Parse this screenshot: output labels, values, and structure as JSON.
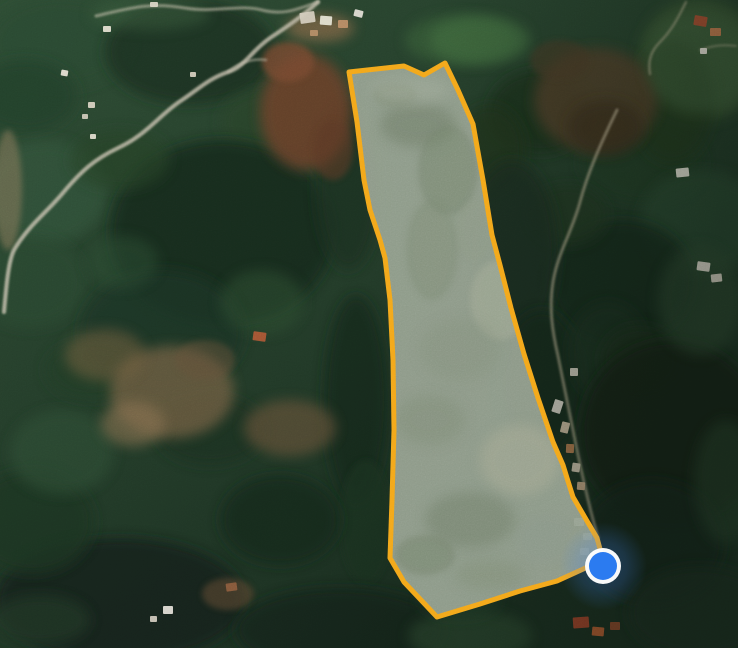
{
  "map": {
    "width": 738,
    "height": 648,
    "type_label": "satellite-imagery",
    "base_gradient": [
      [
        "0",
        "#2e4c34"
      ],
      [
        "1",
        "#1b2f21"
      ]
    ],
    "shade_stops": [
      [
        "0",
        "rgba(8,16,10,0)"
      ],
      [
        "0.55",
        "rgba(8,16,10,0.05)"
      ],
      [
        "1",
        "rgba(8,16,10,0.34)"
      ]
    ],
    "grain_opacity": 0.16
  },
  "forest_blobs": [
    [
      60,
      42,
      72,
      46,
      "#2c4a31",
      0.8
    ],
    [
      25,
      96,
      52,
      36,
      "#24402a",
      0.8
    ],
    [
      190,
      52,
      85,
      52,
      "#1b3020",
      0.85
    ],
    [
      150,
      14,
      60,
      16,
      "#3a5c3c",
      0.5
    ],
    [
      262,
      122,
      42,
      32,
      "#2a452c",
      0.7
    ],
    [
      45,
      192,
      62,
      52,
      "#33523a",
      0.75
    ],
    [
      30,
      282,
      56,
      46,
      "#2b4833",
      0.7
    ],
    [
      222,
      232,
      112,
      92,
      "#182b1e",
      0.85
    ],
    [
      162,
      332,
      82,
      62,
      "#1f3625",
      0.8
    ],
    [
      262,
      302,
      42,
      32,
      "#2f4f33",
      0.55
    ],
    [
      122,
      262,
      36,
      26,
      "#2c4b31",
      0.55
    ],
    [
      120,
      160,
      50,
      30,
      "#274228",
      0.6
    ],
    [
      348,
      185,
      32,
      85,
      "#1c3122",
      0.8
    ],
    [
      356,
      400,
      32,
      105,
      "#192c1f",
      0.8
    ],
    [
      366,
      522,
      26,
      62,
      "#1e3424",
      0.75
    ],
    [
      120,
      600,
      125,
      62,
      "#13231a",
      0.85
    ],
    [
      32,
      522,
      62,
      52,
      "#1c3424",
      0.8
    ],
    [
      62,
      452,
      52,
      42,
      "#2e4e34",
      0.65
    ],
    [
      90,
      370,
      45,
      30,
      "#223c28",
      0.6
    ],
    [
      210,
      430,
      55,
      35,
      "#1d3322",
      0.7
    ],
    [
      280,
      520,
      60,
      45,
      "#182b1e",
      0.8
    ],
    [
      40,
      620,
      50,
      25,
      "#203725",
      0.7
    ],
    [
      340,
      630,
      105,
      42,
      "#15271b",
      0.85
    ],
    [
      470,
      636,
      62,
      26,
      "#2f4c31",
      0.65
    ],
    [
      460,
      600,
      40,
      18,
      "#24402a",
      0.6
    ],
    [
      540,
      112,
      52,
      42,
      "#1b301f",
      0.8
    ],
    [
      490,
      150,
      35,
      45,
      "#20361f",
      0.7
    ],
    [
      460,
      40,
      55,
      25,
      "#3f6a3e",
      0.5
    ],
    [
      642,
      162,
      62,
      42,
      "#243d28",
      0.7
    ],
    [
      700,
      60,
      62,
      62,
      "#3e5a36",
      0.7
    ],
    [
      672,
      102,
      42,
      62,
      "#22381f",
      0.65
    ],
    [
      702,
      222,
      62,
      52,
      "#2c4830",
      0.75
    ],
    [
      622,
      282,
      72,
      62,
      "#182b1e",
      0.85
    ],
    [
      568,
      215,
      40,
      30,
      "#203823",
      0.7
    ],
    [
      512,
      252,
      46,
      92,
      "#1a2e20",
      0.8
    ],
    [
      542,
      382,
      42,
      72,
      "#17291d",
      0.85
    ],
    [
      608,
      352,
      40,
      50,
      "#1d3223",
      0.7
    ],
    [
      640,
      360,
      40,
      35,
      "#1a2e1f",
      0.7
    ],
    [
      672,
      432,
      92,
      92,
      "#122217",
      0.9
    ],
    [
      652,
      542,
      72,
      62,
      "#16281c",
      0.85
    ],
    [
      726,
      482,
      32,
      62,
      "#25402a",
      0.65
    ],
    [
      700,
      612,
      72,
      46,
      "#1a2f20",
      0.8
    ]
  ],
  "terrain_patches": [
    [
      306,
      112,
      46,
      58,
      "#6f432c",
      0.85
    ],
    [
      288,
      62,
      26,
      20,
      "#7c4c30",
      0.8
    ],
    [
      320,
      28,
      34,
      14,
      "#8a6a48",
      0.7
    ],
    [
      333,
      150,
      20,
      30,
      "#5e3a28",
      0.6
    ],
    [
      596,
      100,
      62,
      52,
      "#52402c",
      0.8
    ],
    [
      606,
      128,
      38,
      28,
      "#3a2e1f",
      0.7
    ],
    [
      560,
      60,
      30,
      20,
      "#4a3a28",
      0.6
    ],
    [
      172,
      392,
      62,
      46,
      "#7c6546",
      0.7
    ],
    [
      290,
      428,
      46,
      28,
      "#6b553b",
      0.65
    ],
    [
      133,
      424,
      32,
      22,
      "#8a7251",
      0.6
    ],
    [
      105,
      355,
      40,
      26,
      "#74603f",
      0.55
    ],
    [
      205,
      360,
      30,
      20,
      "#66523a",
      0.5
    ],
    [
      228,
      594,
      26,
      16,
      "#5e4a33",
      0.6
    ],
    [
      700,
      300,
      42,
      55,
      "#2e4a32",
      0.6
    ],
    [
      480,
      40,
      50,
      24,
      "#447243",
      0.65
    ],
    [
      700,
      62,
      55,
      50,
      "#40603c",
      0.6
    ],
    [
      8,
      190,
      14,
      60,
      "#8a7a5c",
      0.55
    ]
  ],
  "roads": [
    {
      "d": "M318,2 C300,18 288,26 270,38 C250,52 246,66 228,72 C208,79 200,88 182,100 C160,114 148,134 118,148 C95,159 82,170 62,194 C45,214 28,226 14,250 C8,262 6,290 4,312",
      "color": "#cfc8b5",
      "width": 4,
      "opacity": 0.8
    },
    {
      "d": "M96,16 C130,8 150,2 185,8 C215,13 240,4 262,10 C285,16 300,8 318,2",
      "color": "#cfc8b5",
      "width": 3,
      "opacity": 0.55
    },
    {
      "d": "M228,72 C240,62 252,58 266,60",
      "color": "#cfc8b5",
      "width": 2.5,
      "opacity": 0.5
    },
    {
      "d": "M617,110 C600,145 588,172 580,202 C572,232 558,252 553,282 C549,308 552,330 558,356 C564,386 570,416 577,450 C583,479 590,510 598,538",
      "color": "#c4b99d",
      "width": 3,
      "opacity": 0.6
    },
    {
      "d": "M686,2 C678,18 672,30 660,42 C650,52 648,62 650,74",
      "color": "#c4b99d",
      "width": 2.5,
      "opacity": 0.5
    },
    {
      "d": "M700,50 C712,46 722,44 736,46",
      "color": "#c4b99d",
      "width": 2,
      "opacity": 0.45
    }
  ],
  "buildings": [
    [
      300,
      12,
      15,
      11,
      "#d9d2c2",
      -8
    ],
    [
      320,
      16,
      12,
      9,
      "#eceada",
      4
    ],
    [
      338,
      20,
      10,
      8,
      "#c09068",
      0
    ],
    [
      354,
      10,
      9,
      7,
      "#e9e6dc",
      14
    ],
    [
      310,
      30,
      8,
      6,
      "#b98f68",
      0
    ],
    [
      103,
      26,
      8,
      6,
      "#e5e1d2",
      0
    ],
    [
      150,
      2,
      8,
      5,
      "#dcd7c7",
      0
    ],
    [
      61,
      70,
      7,
      6,
      "#e8e4d6",
      10
    ],
    [
      88,
      102,
      7,
      6,
      "#d9d3c2",
      0
    ],
    [
      82,
      114,
      6,
      5,
      "#cfc9b8",
      0
    ],
    [
      190,
      72,
      6,
      5,
      "#d6d0bf",
      0
    ],
    [
      90,
      134,
      6,
      5,
      "#e2ddcf",
      0
    ],
    [
      694,
      16,
      13,
      10,
      "#a84e30",
      10
    ],
    [
      710,
      28,
      11,
      8,
      "#c17a4e",
      0
    ],
    [
      700,
      48,
      7,
      6,
      "#e6e2d6",
      0
    ],
    [
      676,
      168,
      13,
      9,
      "#e3dfd3",
      -6
    ],
    [
      697,
      262,
      13,
      9,
      "#ded9cc",
      8
    ],
    [
      711,
      274,
      11,
      8,
      "#d6d0c2",
      -6
    ],
    [
      570,
      368,
      8,
      8,
      "#cfc9ba",
      0
    ],
    [
      553,
      400,
      9,
      13,
      "#d9d5c9",
      18
    ],
    [
      561,
      422,
      8,
      11,
      "#cdbda2",
      14
    ],
    [
      566,
      444,
      8,
      9,
      "#b27c50",
      2
    ],
    [
      572,
      463,
      8,
      9,
      "#d1c6b0",
      8
    ],
    [
      577,
      482,
      8,
      8,
      "#c4a786",
      4
    ],
    [
      574,
      518,
      10,
      8,
      "#e9e6dd",
      0
    ],
    [
      583,
      533,
      9,
      7,
      "#dedacd",
      0
    ],
    [
      580,
      548,
      9,
      7,
      "#e6e3da",
      0
    ],
    [
      573,
      617,
      16,
      11,
      "#a5452b",
      -4
    ],
    [
      592,
      627,
      12,
      9,
      "#b95f33",
      5
    ],
    [
      610,
      622,
      10,
      8,
      "#8f4a2c",
      0
    ],
    [
      253,
      332,
      13,
      9,
      "#b05a36",
      8
    ],
    [
      226,
      583,
      11,
      8,
      "#8f5e3e",
      -8
    ],
    [
      163,
      606,
      10,
      8,
      "#e8e5dc",
      0
    ],
    [
      150,
      616,
      7,
      6,
      "#d4cec0",
      0
    ]
  ],
  "parcel": {
    "points": [
      [
        349,
        72
      ],
      [
        404,
        66
      ],
      [
        424,
        75
      ],
      [
        445,
        63
      ],
      [
        458,
        90
      ],
      [
        473,
        124
      ],
      [
        483,
        180
      ],
      [
        492,
        235
      ],
      [
        500,
        265
      ],
      [
        511,
        308
      ],
      [
        524,
        354
      ],
      [
        538,
        398
      ],
      [
        553,
        442
      ],
      [
        563,
        465
      ],
      [
        567,
        478
      ],
      [
        573,
        497
      ],
      [
        587,
        521
      ],
      [
        597,
        538
      ],
      [
        603,
        560
      ],
      [
        557,
        581
      ],
      [
        520,
        591
      ],
      [
        480,
        604
      ],
      [
        437,
        617
      ],
      [
        404,
        582
      ],
      [
        390,
        558
      ],
      [
        392,
        500
      ],
      [
        394,
        430
      ],
      [
        393,
        360
      ],
      [
        390,
        300
      ],
      [
        385,
        258
      ],
      [
        380,
        240
      ],
      [
        370,
        210
      ],
      [
        364,
        180
      ],
      [
        357,
        122
      ]
    ],
    "fill": "#97a291",
    "fill_opacity": 0.93,
    "stroke": "#f3a71b",
    "stroke_width": 5,
    "texture": [
      [
        395,
        95,
        22,
        12,
        "#7a876f",
        0.5
      ],
      [
        418,
        125,
        38,
        22,
        "#6e7c66",
        0.55
      ],
      [
        448,
        170,
        30,
        45,
        "#75836d",
        0.5
      ],
      [
        432,
        250,
        26,
        50,
        "#7b8973",
        0.45
      ],
      [
        475,
        230,
        18,
        30,
        "#8d9a84",
        0.4
      ],
      [
        500,
        300,
        30,
        40,
        "#a4ab96",
        0.5
      ],
      [
        460,
        350,
        40,
        30,
        "#828f7a",
        0.4
      ],
      [
        430,
        420,
        35,
        25,
        "#7d8a74",
        0.45
      ],
      [
        520,
        460,
        40,
        35,
        "#a7aa94",
        0.55
      ],
      [
        470,
        520,
        45,
        28,
        "#6f7d68",
        0.5
      ],
      [
        425,
        555,
        30,
        20,
        "#73816b",
        0.5
      ],
      [
        490,
        575,
        35,
        15,
        "#7f8c75",
        0.45
      ],
      [
        410,
        90,
        40,
        14,
        "#a0aa9a",
        0.5
      ],
      [
        545,
        540,
        30,
        25,
        "#8b988a",
        0.45
      ]
    ]
  },
  "marker": {
    "cx": 603,
    "cy": 566,
    "dot_radius": 14,
    "ring_outer_radius": 18,
    "halo_radius": 44,
    "dot_color": "#2b7bf0",
    "ring_color": "#ffffff",
    "halo_color": "#4285f4"
  }
}
